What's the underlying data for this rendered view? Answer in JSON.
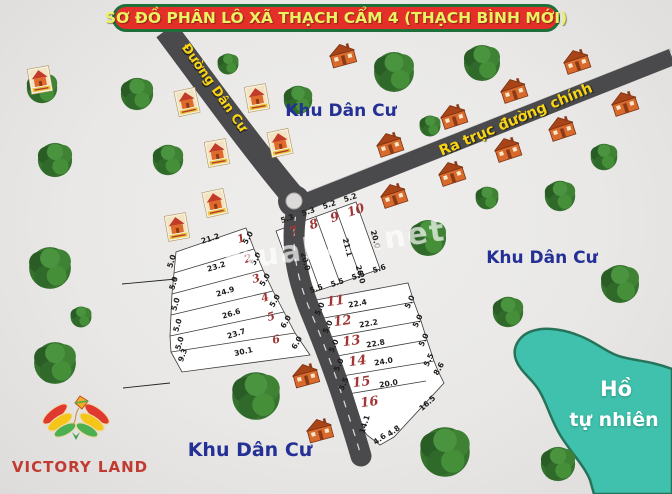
{
  "title": "SƠ ĐỒ PHÂN LÔ XÃ THẠCH CẨM 4 (THẠCH BÌNH MỚI)",
  "road_labels": {
    "residential": "Đường Dân Cư",
    "main_axis": "Ra trục đường chính"
  },
  "area_labels": {
    "top": "Khu Dân Cư",
    "right": "Khu Dân Cư",
    "bottom": "Khu Dân Cư",
    "lake1": "Hồ",
    "lake2": "tự nhiên"
  },
  "watermark": "muaban.net",
  "brand": "VICTORY LAND",
  "plot_numbers": [
    "1",
    "2",
    "3",
    "4",
    "5",
    "6",
    "7",
    "8",
    "9",
    "10",
    "11",
    "12",
    "13",
    "14",
    "15",
    "16"
  ],
  "dimensions": [
    "21.2",
    "23.2",
    "24.9",
    "26.6",
    "23.7",
    "30.1",
    "5.0",
    "5.0",
    "5.0",
    "5.0",
    "5.0",
    "9.3",
    "5.0",
    "5.0",
    "5.0",
    "5.0",
    "6.0",
    "6.0",
    "5.3",
    "5.3",
    "5.2",
    "5.2",
    "20.0",
    "21.1",
    "20.0",
    "20.0",
    "5.5",
    "5.5",
    "5.5",
    "5.6",
    "22.4",
    "22.2",
    "22.8",
    "24.0",
    "20.0",
    "5.0",
    "5.0",
    "5.0",
    "5.0",
    "5.5",
    "5.0",
    "5.0",
    "5.0",
    "5.5",
    "8.6",
    "16.5",
    "14.1",
    "4.6",
    "4.8"
  ],
  "colors": {
    "banner_bg": "#e43029",
    "banner_border": "#1e6f3a",
    "banner_text": "#e9f262",
    "road": "#4a4a4c",
    "road_text": "#f8d414",
    "area_text": "#243095",
    "lake_fill": "#3fc1ad",
    "lake_border": "#27735a",
    "plot_number_text": "#a03636",
    "brand_text": "#c13b32",
    "tree_green": "#35722e"
  }
}
